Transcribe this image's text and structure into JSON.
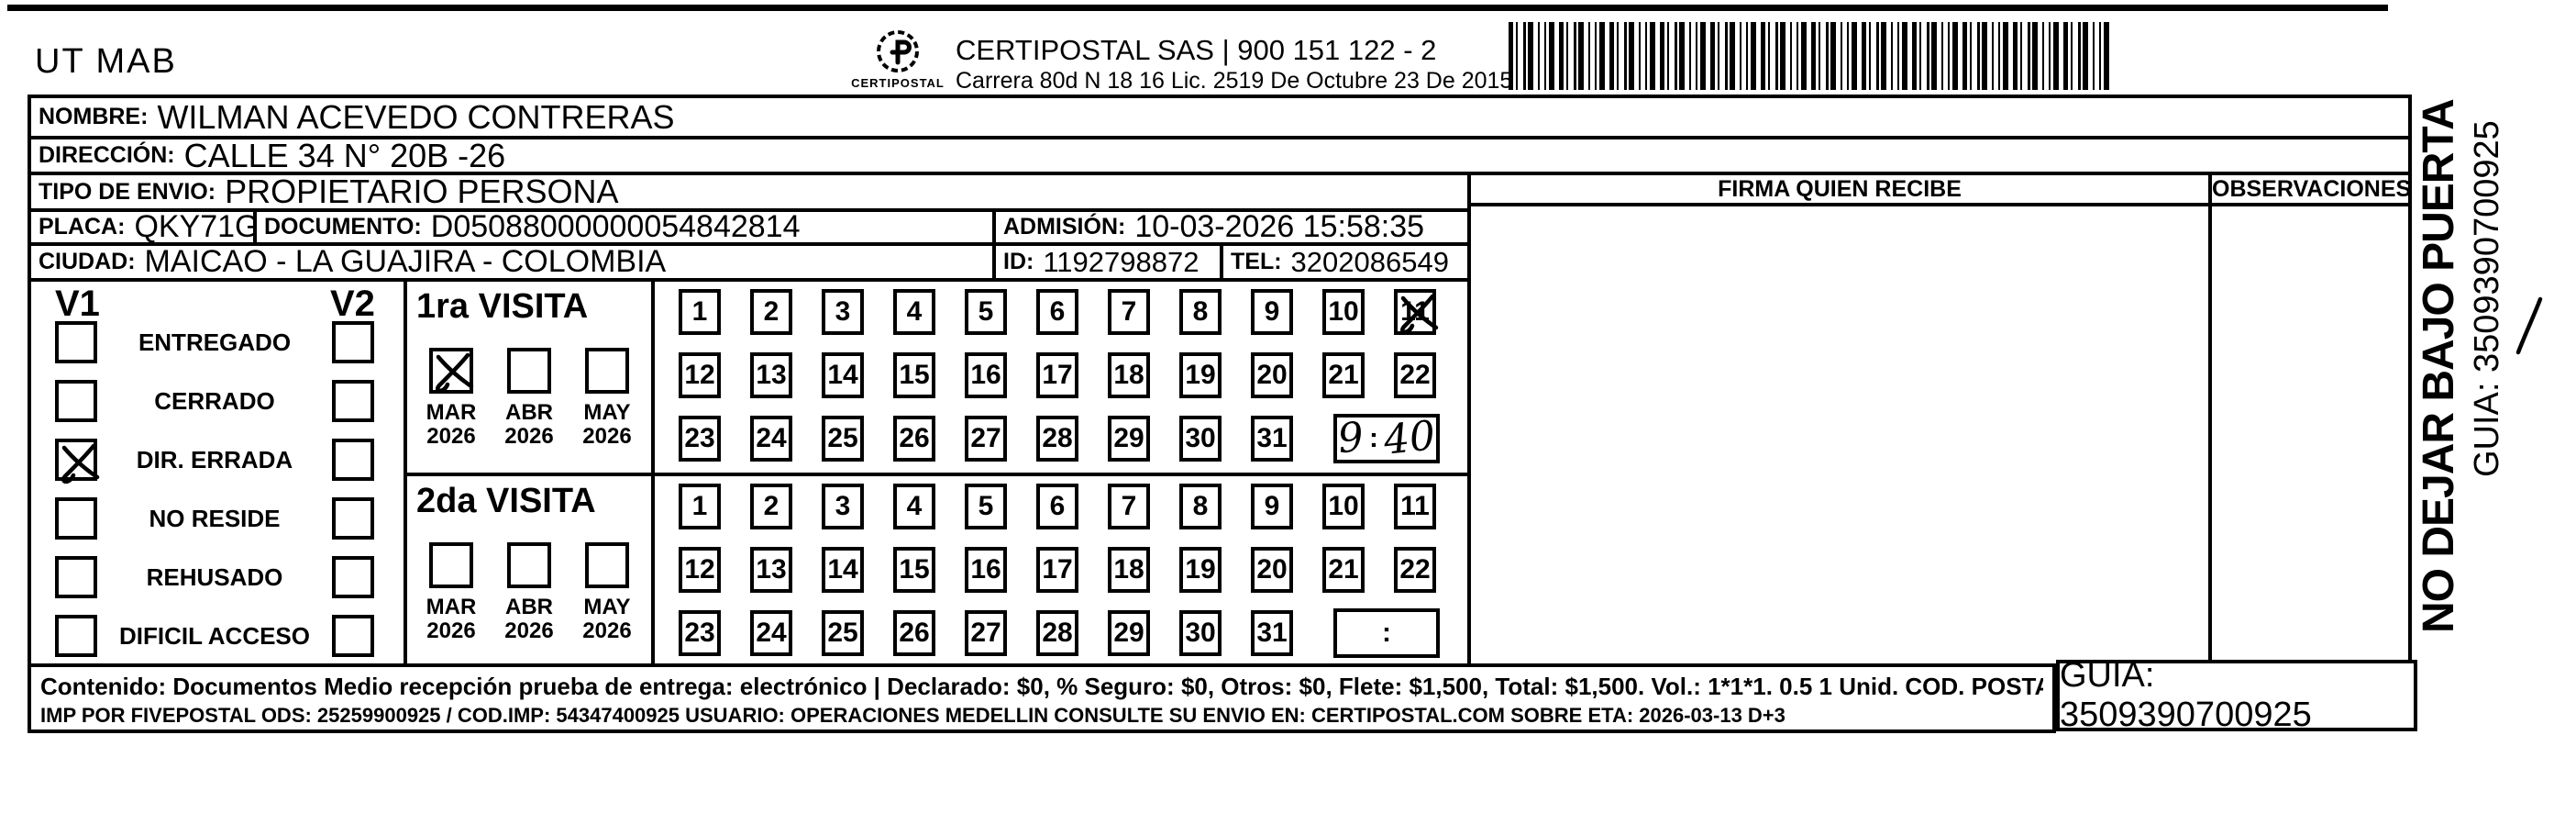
{
  "header": {
    "sender_code": "UT MAB",
    "nit_line": "NIT 901783814 - 6049499",
    "address_line": "DIAGONAL 50 A # 42 - 95  BELLO  ANTIOQUIA",
    "logo_caption": "CERTIPOSTAL",
    "company_line1": "CERTIPOSTAL SAS | 900 151 122 - 2",
    "company_line2": "Carrera 80d N 18 16  Lic. 2519 De Octubre 23 De 2015"
  },
  "recipient": {
    "nombre_label": "NOMBRE:",
    "nombre": "WILMAN ACEVEDO CONTRERAS",
    "direccion_label": "DIRECCIÓN:",
    "direccion": "CALLE 34 N° 20B -26",
    "tipo_label": "TIPO DE ENVIO:",
    "tipo": "PROPIETARIO PERSONA",
    "placa_label": "PLACA:",
    "placa": "QKY71G",
    "documento_label": "DOCUMENTO:",
    "documento": "D05088000000054842814",
    "admision_label": "ADMISIÓN:",
    "admision": "10-03-2026 15:58:35",
    "ciudad_label": "CIUDAD:",
    "ciudad": "MAICAO - LA GUAJIRA - COLOMBIA",
    "id_label": "ID:",
    "id": "1192798872",
    "tel_label": "TEL:",
    "tel": "3202086549"
  },
  "delivery": {
    "v1_label": "V1",
    "v2_label": "V2",
    "statuses": [
      "ENTREGADO",
      "CERRADO",
      "DIR. ERRADA",
      "NO RESIDE",
      "REHUSADO",
      "DIFICIL ACCESO"
    ],
    "v1_checked_index": 2,
    "visit1_title": "1ra VISITA",
    "visit2_title": "2da VISITA",
    "months": [
      {
        "month": "MAR",
        "year": "2026"
      },
      {
        "month": "ABR",
        "year": "2026"
      },
      {
        "month": "MAY",
        "year": "2026"
      }
    ],
    "visit1_checked_month_index": 0,
    "days": [
      1,
      2,
      3,
      4,
      5,
      6,
      7,
      8,
      9,
      10,
      11,
      12,
      13,
      14,
      15,
      16,
      17,
      18,
      19,
      20,
      21,
      22,
      23,
      24,
      25,
      26,
      27,
      28,
      29,
      30,
      31
    ],
    "visit1_crossed_day": 11,
    "visit1_time": "9:40",
    "time_placeholder": ":"
  },
  "signature": {
    "firma_label": "FIRMA QUIEN RECIBE",
    "obs_label": "OBSERVACIONES"
  },
  "side_note": {
    "warning": "NO DEJAR BAJO PUERTA",
    "guia": "GUIA: 3509390700925"
  },
  "footer": {
    "content_line": "Contenido: Documentos Medio recepción prueba de entrega: electrónico | Declarado: $0, % Seguro: $0, Otros: $0, Flete: $1,500, Total: $1,500. Vol.: 1*1*1. 0.5  1 Unid. COD. POSTAL: 442001",
    "imp_line": "IMP POR FIVEPOSTAL ODS: 25259900925 / COD.IMP: 54347400925 USUARIO: OPERACIONES MEDELLIN CONSULTE SU ENVIO EN: CERTIPOSTAL.COM SOBRE ETA: 2026-03-13 D+3",
    "guia_box": "GUIA: 3509390700925"
  }
}
